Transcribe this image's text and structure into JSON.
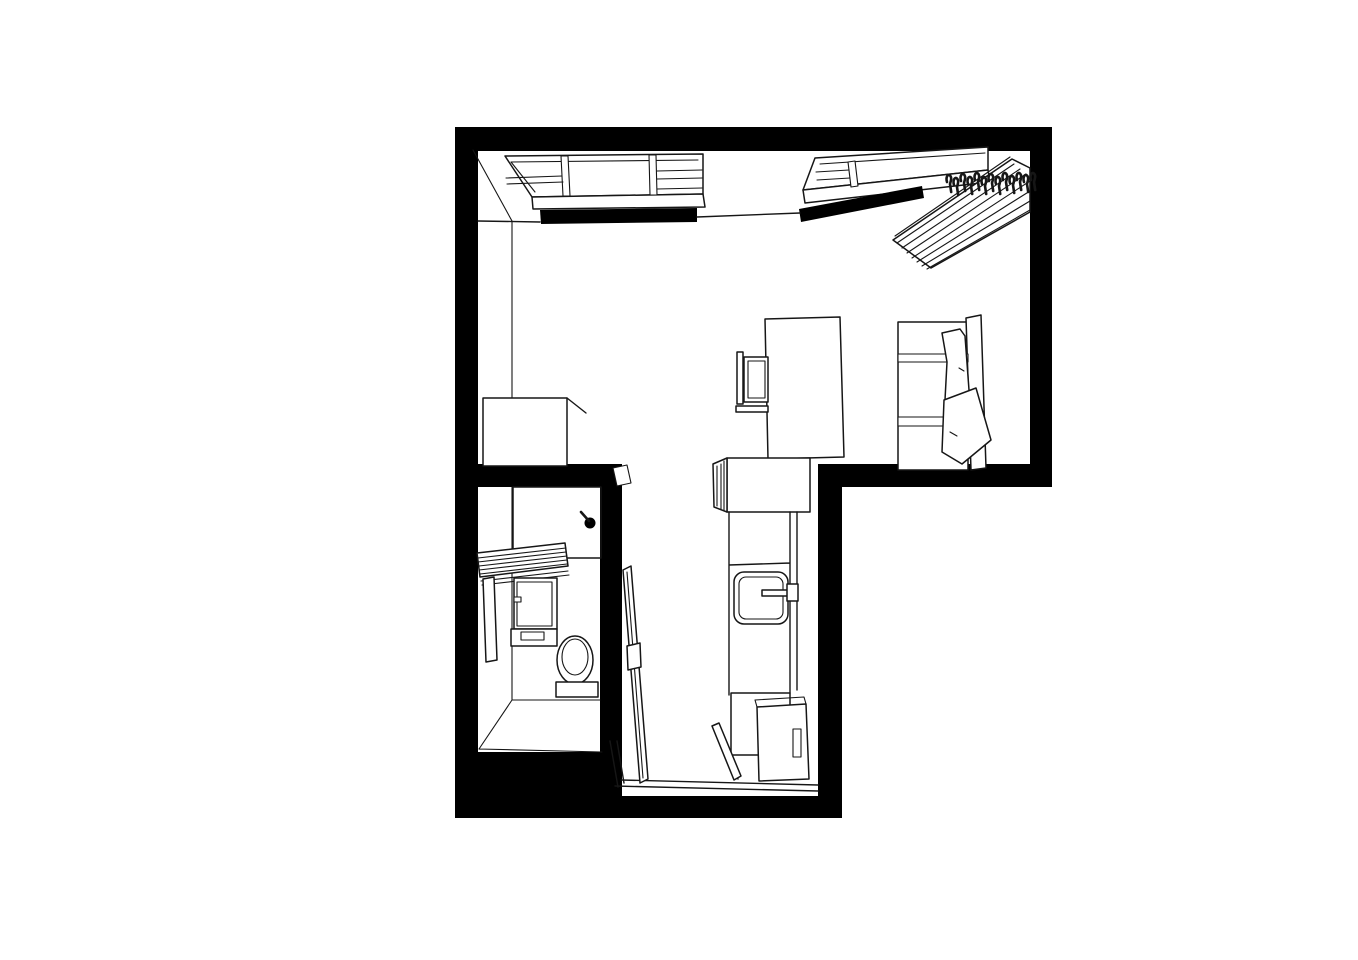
{
  "plan": {
    "title": "studio-apartment-floor-plan-axonometric",
    "ink": "#161616",
    "wall": "#000000",
    "paper": "#ffffff",
    "rooms": [
      {
        "name": "main-room",
        "items": [
          "window-left",
          "window-right",
          "curtain-rail",
          "clothes-rack",
          "hanger-hooks",
          "bed",
          "bed-pillows",
          "desk",
          "desk-chair",
          "storage-box"
        ]
      },
      {
        "name": "bathroom",
        "items": [
          "shower",
          "shower-head",
          "towel-shelf",
          "vanity-cabinet",
          "vanity-drawer",
          "side-panel",
          "toilet",
          "bathroom-door"
        ]
      },
      {
        "name": "kitchen-hallway",
        "items": [
          "tall-cabinet",
          "counter",
          "sink",
          "faucet",
          "lower-cabinet",
          "refrigerator",
          "entry-threshold",
          "entry-door"
        ]
      }
    ]
  }
}
